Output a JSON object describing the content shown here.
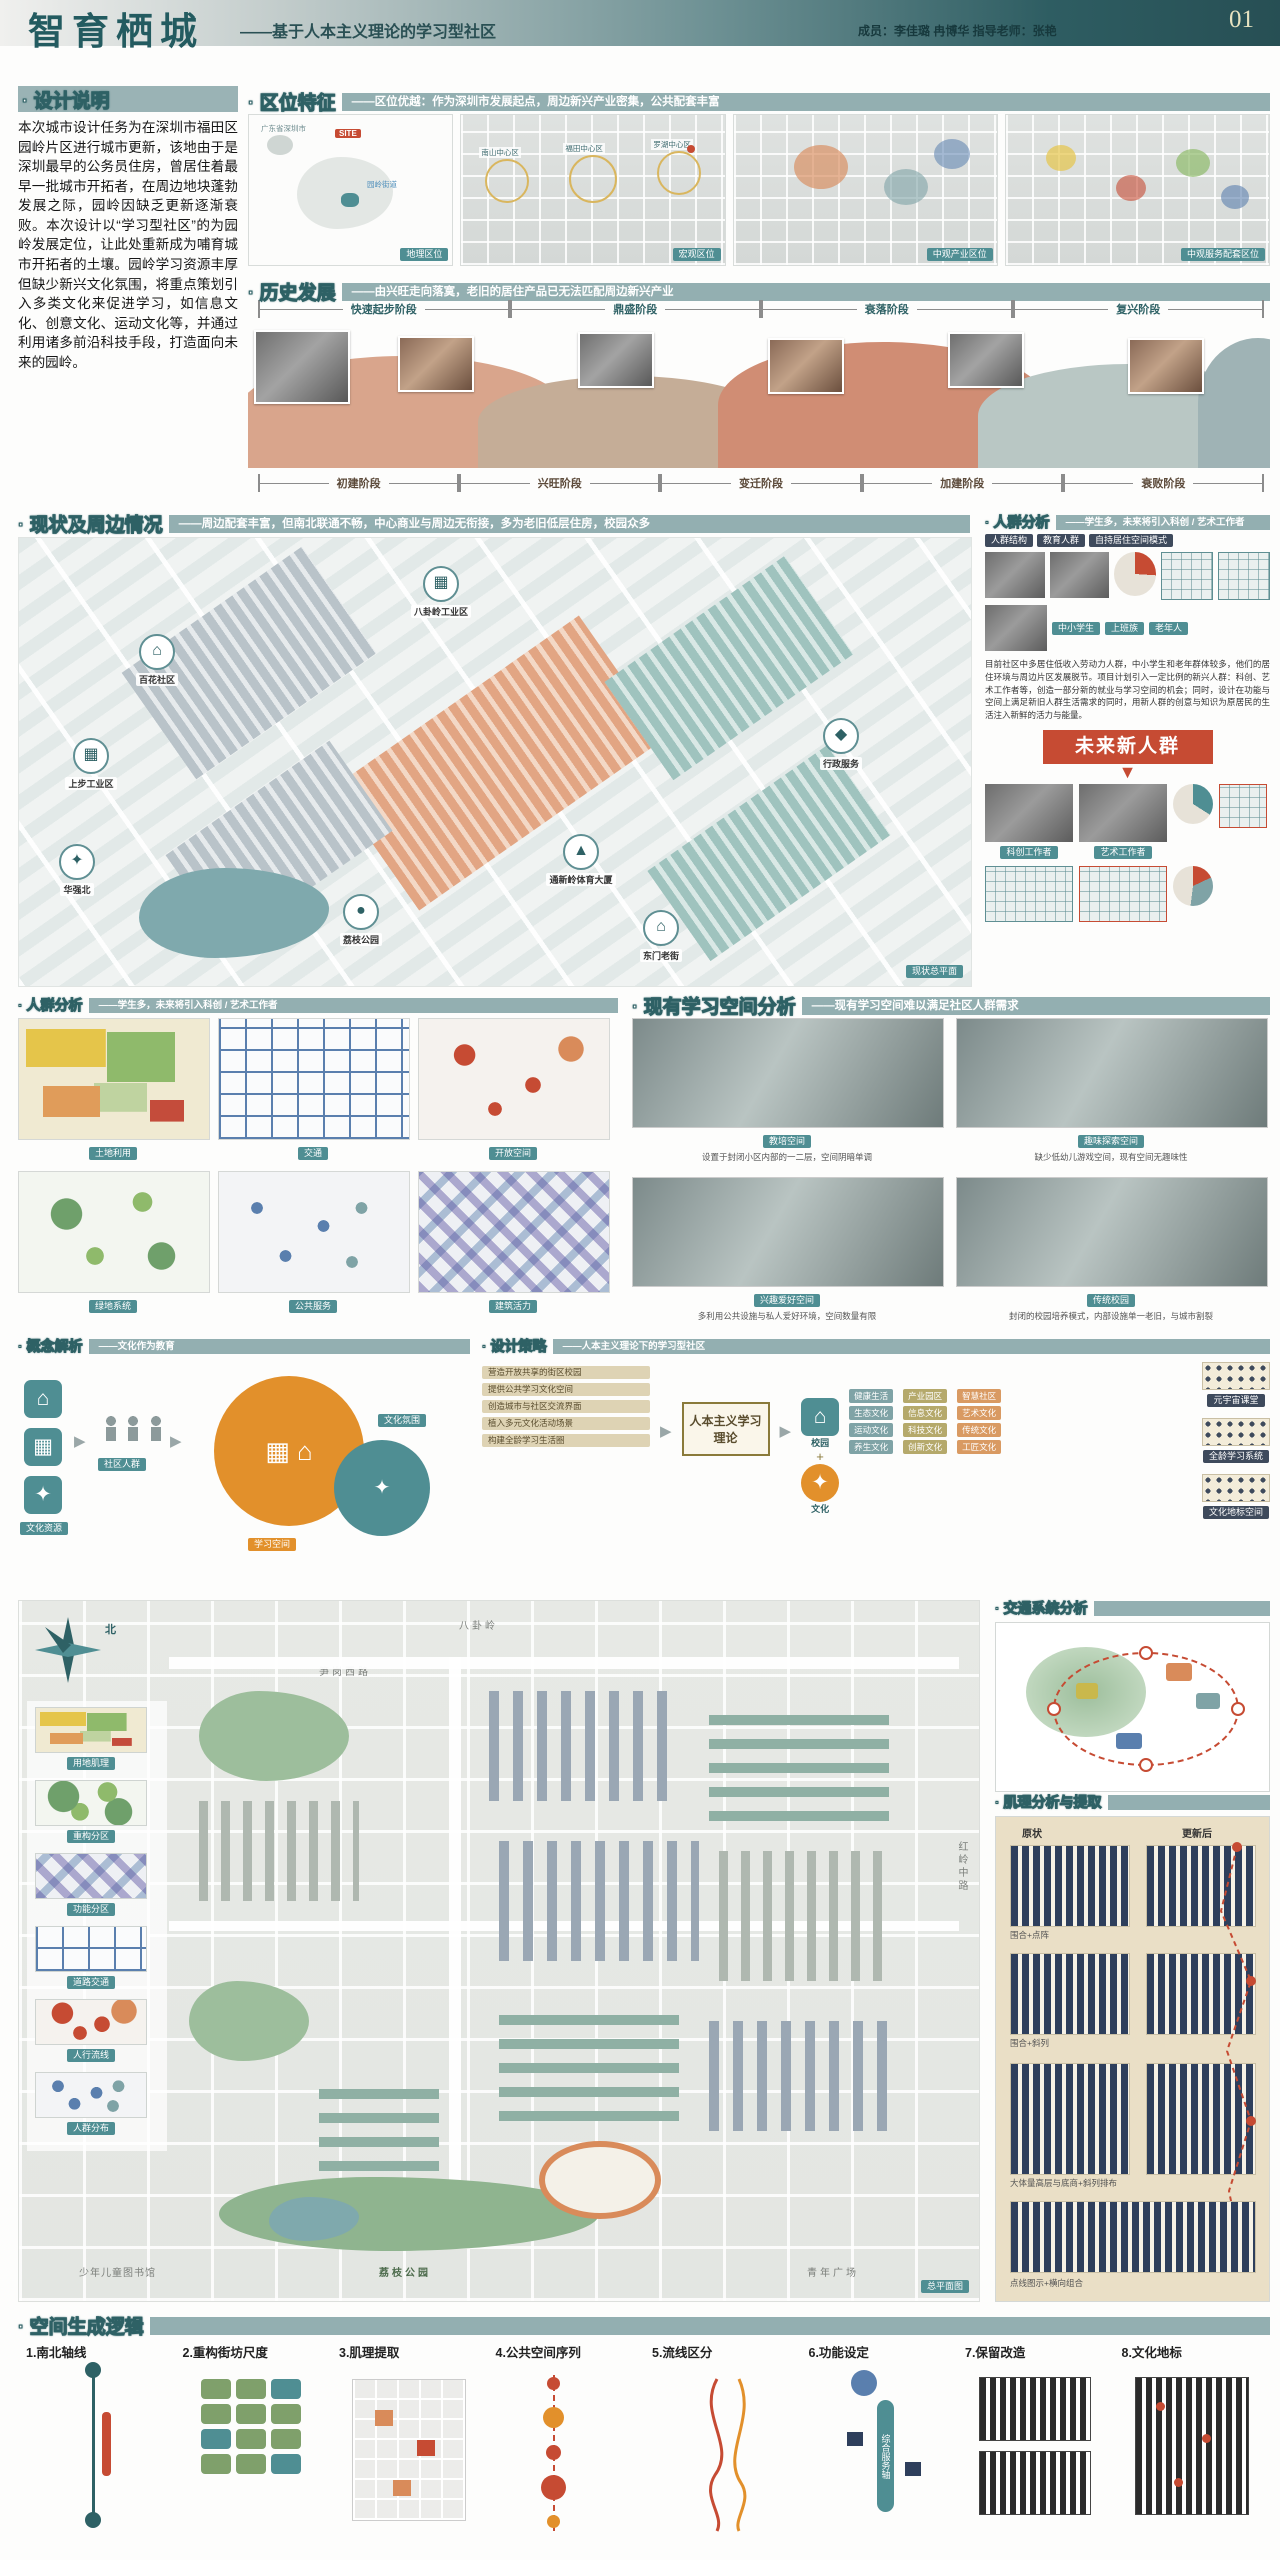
{
  "colors": {
    "accent_teal": "#2E6165",
    "bar_teal": "#93AFB1",
    "badge_red": "#C64B33",
    "concept_orange": "#E2902B",
    "panel_beige": "#EADFC6",
    "block_navy": "#2E3F5C"
  },
  "header": {
    "title": "智育栖城",
    "subtitle": "——基于人本主义理论的学习型社区",
    "credits": "成员：李佳璐 冉博华  指导老师：张艳",
    "page_no": "01"
  },
  "design_note": {
    "title": "· 设计说明",
    "body": "本次城市设计任务为在深圳市福田区园岭片区进行城市更新，该地由于是深圳最早的公务员住房，曾居住着最早一批城市开拓者，在周边地块蓬勃发展之际，园岭因缺乏更新逐渐衰败。本次设计以“学习型社区”的为园岭发展定位，让此处重新成为哺育城市开拓者的土壤。园岭学习资源丰厚但缺少新兴文化氛围，将重点策划引入多类文化来促进学习，如信息文化、创意文化、运动文化等，并通过利用诸多前沿科技手段，打造面向未来的园岭。"
  },
  "location": {
    "title": "· 区位特征",
    "tagline": "——区位优越：作为深圳市发展起点，周边新兴产业密集，公共配套丰富",
    "site_label": "SITE",
    "map1_labels": [
      "广东省深圳市",
      "园岭街道"
    ],
    "ring_labels": [
      "南山中心区",
      "福田中心区",
      "罗湖中心区"
    ],
    "maps": [
      {
        "caption": "地理区位"
      },
      {
        "caption": "宏观区位"
      },
      {
        "caption": "中观产业区位"
      },
      {
        "caption": "中观服务配套区位"
      }
    ]
  },
  "history": {
    "title": "· 历史发展",
    "tagline": "——由兴旺走向落寞，老旧的居住产品已无法匹配周边新兴产业",
    "top_phases": [
      "快速起步阶段",
      "鼎盛阶段",
      "衰落阶段",
      "复兴阶段"
    ],
    "bottom_phases": [
      "初建阶段",
      "兴旺阶段",
      "变迁阶段",
      "加建阶段",
      "衰败阶段"
    ]
  },
  "status": {
    "title": "· 现状及周边情况",
    "tagline": "——周边配套丰富，但南北联通不畅，中心商业与周边无衔接，多为老旧低层住房，校园众多",
    "plan_caption": "现状总平面",
    "callouts": [
      {
        "icon": "▦",
        "label": "八卦岭工业区"
      },
      {
        "icon": "⌂",
        "label": "百花社区"
      },
      {
        "icon": "▦",
        "label": "上步工业区"
      },
      {
        "icon": "✦",
        "label": "华强北"
      },
      {
        "icon": "●",
        "label": "荔枝公园"
      },
      {
        "icon": "⌂",
        "label": "东门老街"
      },
      {
        "icon": "◆",
        "label": "行政服务"
      },
      {
        "icon": "▲",
        "label": "通新岭体育大厦"
      }
    ]
  },
  "crowd": {
    "title": "· 人群分析",
    "tagline": "——学生多，未来将引入科创 / 艺术工作者",
    "col_heads": [
      "人群结构",
      "教育人群",
      "自持居住空间模式"
    ],
    "person_tags": [
      "中小学生",
      "上班族",
      "老年人"
    ],
    "desc": "目前社区中多居住低收入劳动力人群，中小学生和老年群体较多，他们的居住环境与周边片区发展脱节。项目计划引入一定比例的新兴人群：科创、艺术工作者等，创造一部分新的就业与学习空间的机会；同时，设计在功能与空间上满足新旧人群生活需求的同时，用新人群的创意与知识为原居民的生活注入新鲜的活力与能量。",
    "badge": "未来新人群",
    "future": [
      "科创工作者",
      "艺术工作者"
    ]
  },
  "analysis": {
    "title": "· 人群分析",
    "tagline": "——学生多，未来将引入科创 / 艺术工作者",
    "maps": [
      {
        "caption": "土地利用"
      },
      {
        "caption": "交通"
      },
      {
        "caption": "开放空间"
      },
      {
        "caption": "绿地系统"
      },
      {
        "caption": "公共服务"
      },
      {
        "caption": "建筑活力"
      }
    ]
  },
  "learning": {
    "title": "· 现有学习空间分析",
    "tagline": "——现有学习空间难以满足社区人群需求",
    "panels": [
      {
        "caption": "教培空间",
        "desc": "设置于封闭小区内部的一二层，空间阴暗单调"
      },
      {
        "caption": "趣味探索空间",
        "desc": "缺少低幼儿游戏空间，现有空间无趣味性"
      },
      {
        "caption": "兴趣爱好空间",
        "desc": "多利用公共设施与私人爱好环境，空间数量有限"
      },
      {
        "caption": "传统校园",
        "desc": "封闭的校园培养模式，内部设施单一老旧，与城市割裂"
      }
    ]
  },
  "concept": {
    "title": "· 概念解析",
    "tagline": "——文化作为教育",
    "labels": [
      "文化资源",
      "社区人群",
      "学习空间",
      "文化氛围"
    ]
  },
  "strategy": {
    "title": "· 设计策略",
    "tagline": "——人本主义理论下的学习型社区",
    "center": "人本主义学习理论",
    "left_items": [
      "营造开放共享的街区校园",
      "提供公共学习文化空间",
      "创造城市与社区交流界面",
      "植入多元文化活动场景",
      "构建全龄学习生活圈"
    ],
    "icons": [
      {
        "label": "校园"
      },
      {
        "label": "文化"
      }
    ],
    "tag_cols": [
      [
        "健康生活",
        "生态文化",
        "运动文化",
        "养生文化"
      ],
      [
        "产业园区",
        "信息文化",
        "科技文化",
        "创新文化"
      ],
      [
        "智慧社区",
        "艺术文化",
        "传统文化",
        "工匠文化"
      ]
    ],
    "right_rows": [
      "元宇宙课堂",
      "全龄学习系统",
      "文化地标空间"
    ]
  },
  "traffic": {
    "title": "· 交通系统分析"
  },
  "texture": {
    "title": "· 肌理分析与提取",
    "col_left": "原状",
    "col_right": "更新后",
    "rows": [
      "围合+点阵",
      "围合+斜列",
      "大体量高层与底商+斜列排布"
    ],
    "bottom_caption": "点线图示+横向组合"
  },
  "masterplan": {
    "compass": "北",
    "street_top": "八卦岭",
    "street_road": "笋岗西路",
    "street_right": "红岭中路",
    "lib": "少年儿童图书馆",
    "park": "荔枝公园",
    "plaza": "青年广场",
    "caption": "总平面图",
    "minis": [
      {
        "label": "用地肌理"
      },
      {
        "label": "重构分区"
      },
      {
        "label": "功能分区"
      },
      {
        "label": "道路交通"
      },
      {
        "label": "人行流线"
      },
      {
        "label": "人群分布"
      }
    ]
  },
  "steps": {
    "title": "· 空间生成逻辑",
    "axis_label": "综合服务轴",
    "items": [
      "1.南北轴线",
      "2.重构街坊尺度",
      "3.肌理提取",
      "4.公共空间序列",
      "5.流线区分",
      "6.功能设定",
      "7.保留改造",
      "8.文化地标"
    ]
  }
}
